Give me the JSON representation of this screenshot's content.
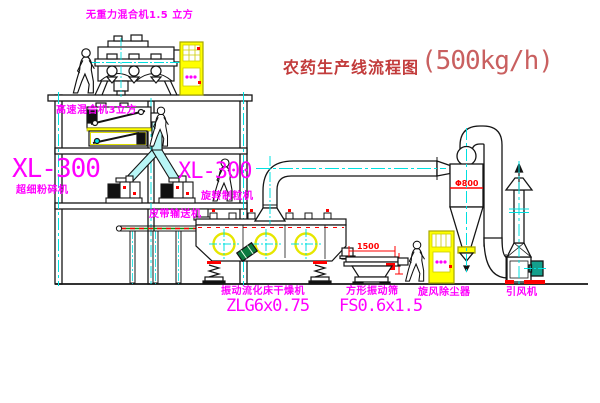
{
  "title": {
    "text": "农药生产线流程图",
    "capacity": "(500kg/h)"
  },
  "equipment": {
    "gravity_mixer": {
      "label": "无重力混合机1.5 立方"
    },
    "high_speed_mixer": {
      "label": "高速混合机3立方"
    },
    "pulverizer": {
      "model": "XL-300",
      "label": "超细粉碎机"
    },
    "granulator": {
      "model": "XL-300",
      "label": "旋转制粒机"
    },
    "belt_conveyor": {
      "label": "皮带输送机"
    },
    "dryer": {
      "label": "振动流化床干燥机",
      "model": "ZLG6x0.75"
    },
    "sieve": {
      "label": "方形振动筛",
      "model": "FS0.6x1.5",
      "dim_width": "1500"
    },
    "cyclone": {
      "label": "旋风除尘器",
      "dim_diameter": "Φ800"
    },
    "fan": {
      "label": "引风机"
    }
  },
  "colors": {
    "label_magenta": "#ff00ff",
    "title_red": "#c23b3b",
    "line_black": "#151515",
    "centerline_cyan": "#00e0e0",
    "highlight_yellow": "#ffff00",
    "detail_red": "#ff0000",
    "pipe_cyan": "#b8f6f6",
    "motor_green": "#0c7a40"
  }
}
